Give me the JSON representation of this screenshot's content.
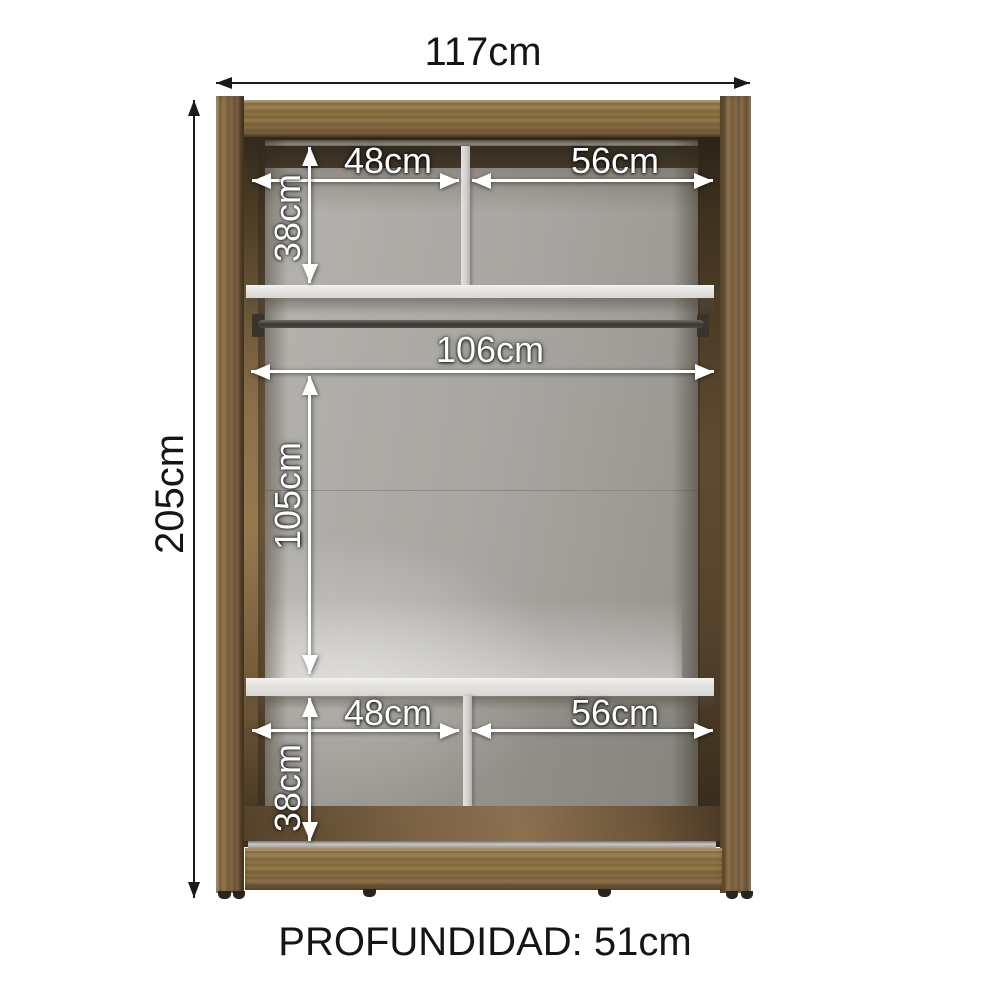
{
  "diagram": {
    "kind": "wardrobe-interior-dimension-diagram",
    "labels": {
      "width_total": "117cm",
      "height_total": "205cm",
      "top_left_width": "48cm",
      "top_right_width": "56cm",
      "top_section_height": "38cm",
      "rod_span": "106cm",
      "main_section_height": "105cm",
      "bottom_left_width": "48cm",
      "bottom_right_width": "56cm",
      "bottom_section_height": "38cm",
      "depth": "PROFUNDIDAD: 51cm"
    },
    "colors": {
      "wood": "#89703f",
      "wood_shadow": "#42382a",
      "back_panel": "#a7a5a0",
      "shelf": "#e8e6e2",
      "interior_dimension_text": "#ffffff",
      "outer_dimension_text": "#151515",
      "background": "#ffffff"
    }
  }
}
